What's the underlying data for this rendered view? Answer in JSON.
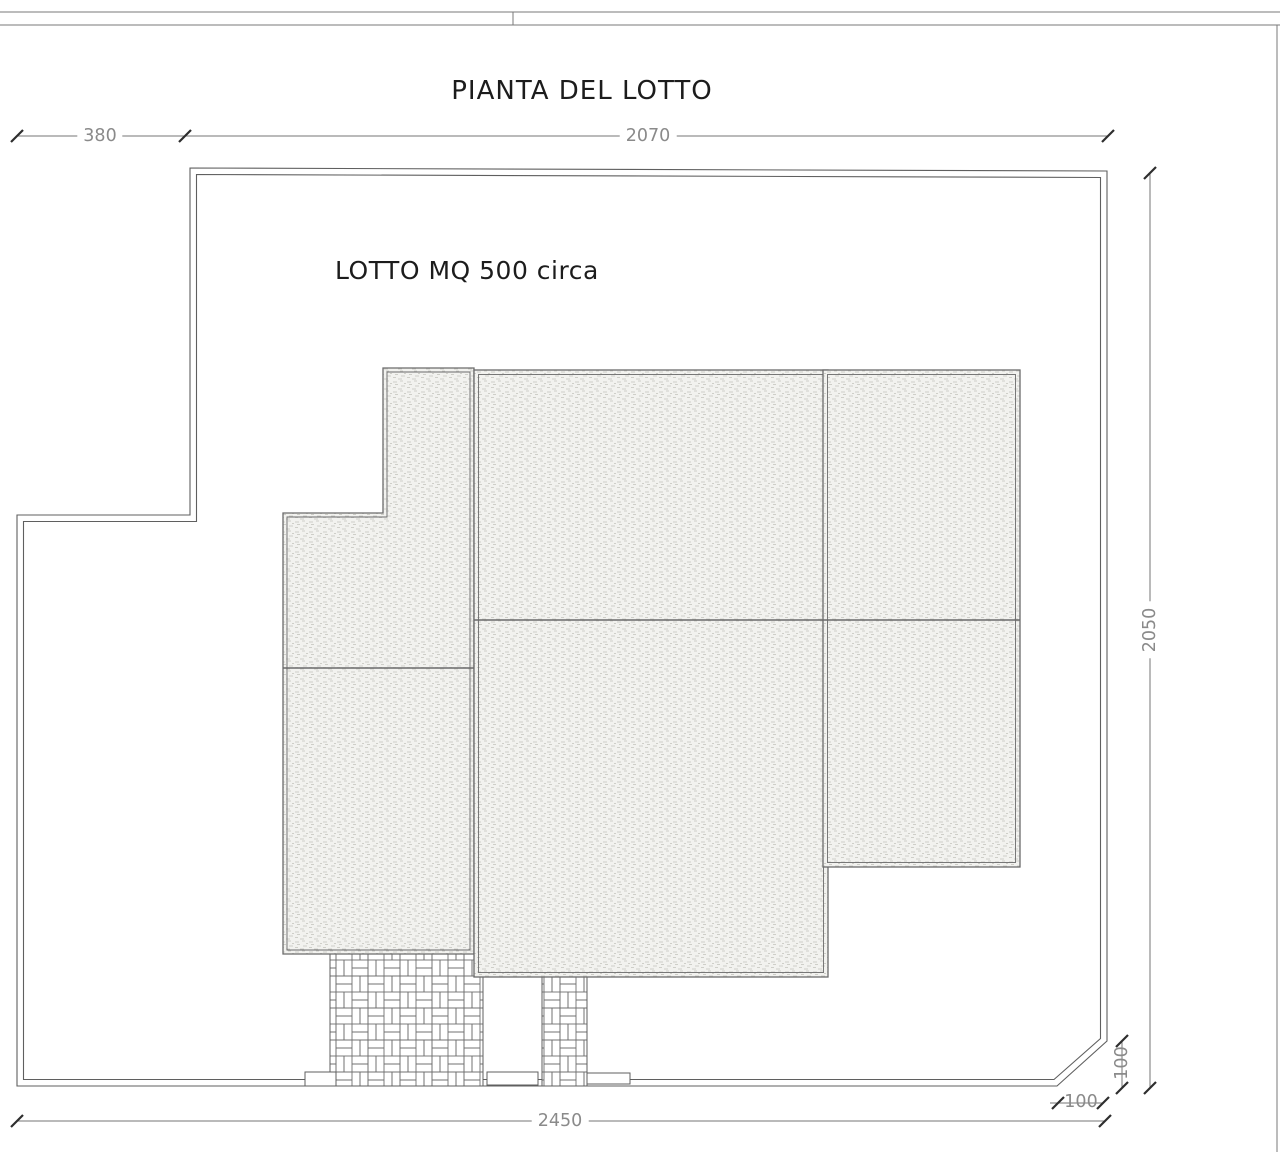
{
  "title": "PIANTA DEL LOTTO",
  "plan": {
    "lot_area_label": "LOTTO MQ 500 circa",
    "dimensions": {
      "left_offset": "380",
      "top_width": "2070",
      "right_height": "2050",
      "bottom_width": "2450",
      "chamfer_height": "100",
      "chamfer_width": "100"
    },
    "colors": {
      "boundary_line": "#5f5f5f",
      "dimension_line": "#757575",
      "tick_mark": "#2e2e2e",
      "dimension_text": "#8a8a8a",
      "title_text": "#1c1c1c",
      "building_fill": "#f2f2ef",
      "paper": "#ffffff"
    }
  }
}
